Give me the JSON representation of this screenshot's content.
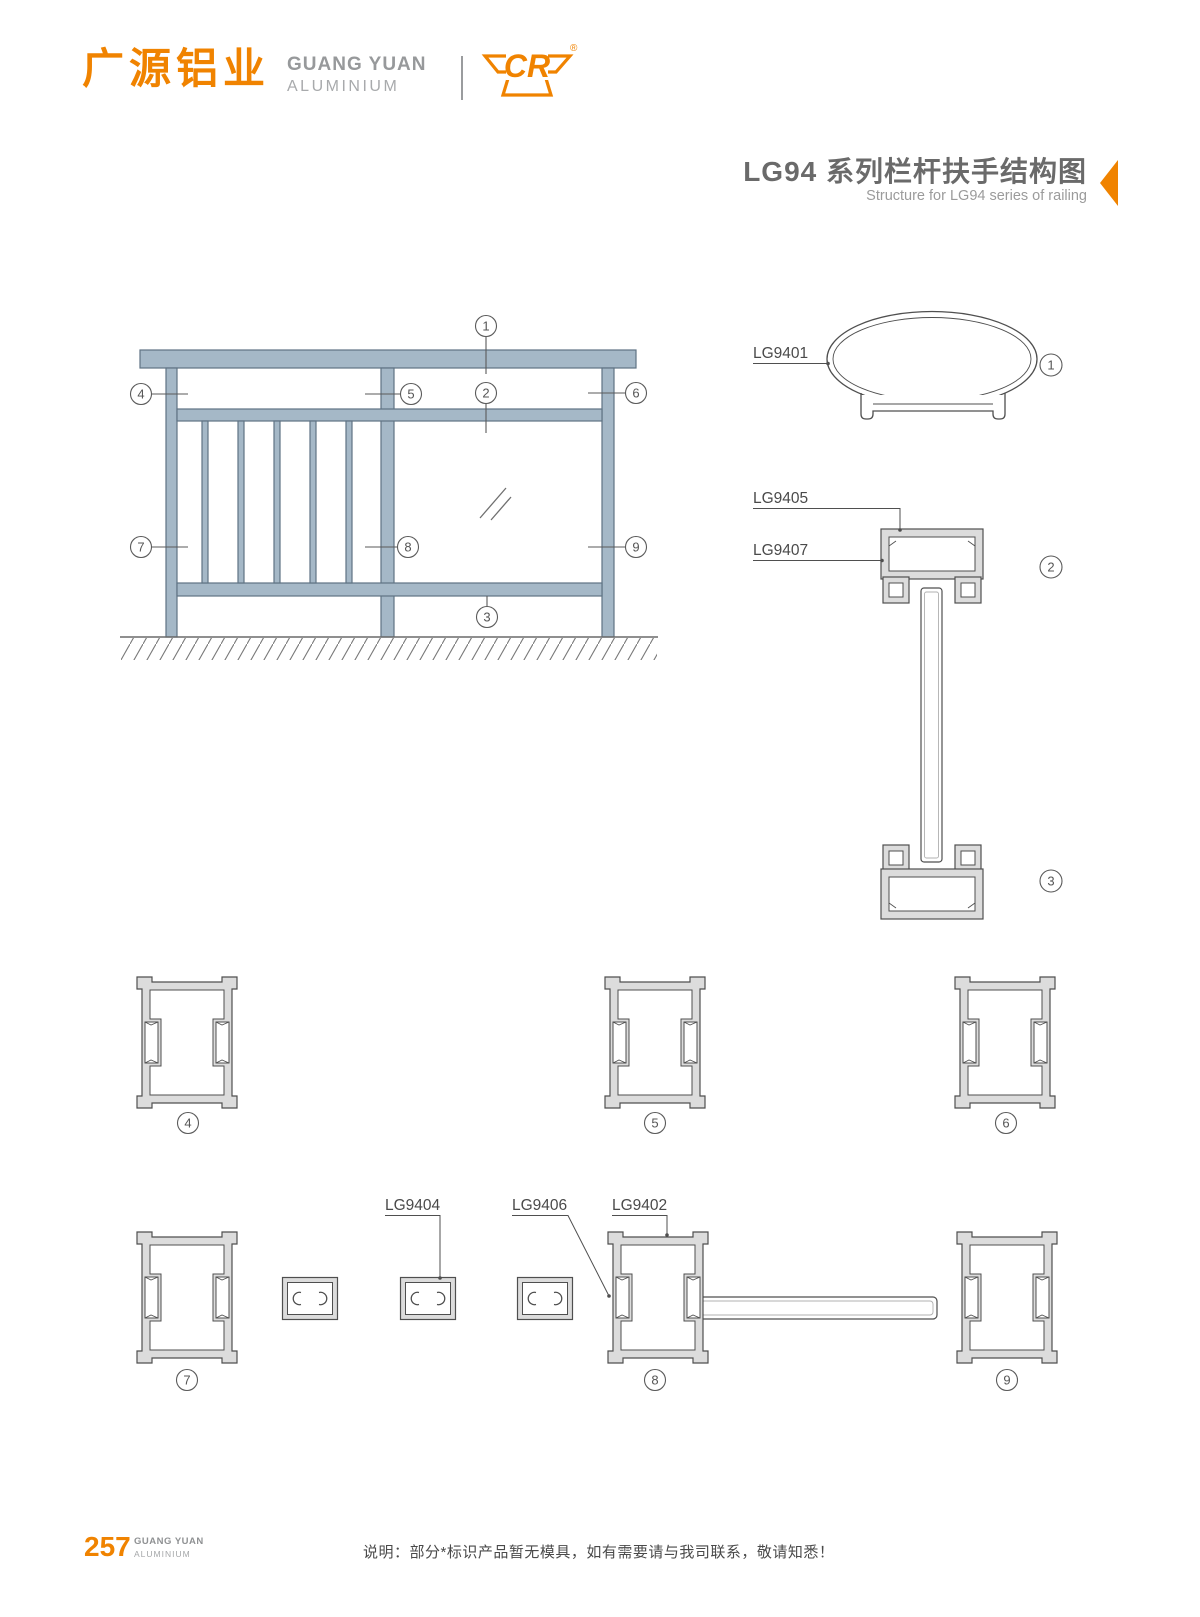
{
  "header": {
    "logo_cn": "广源铝业",
    "logo_en_1": "GUANG YUAN",
    "logo_en_2": "ALUMINIUM",
    "logo_mark": "CR",
    "logo_reg": "®",
    "title_cn": "LG94 系列栏杆扶手结构图",
    "title_en": "Structure for LG94 series of railing"
  },
  "diagram": {
    "callouts": {
      "c1": "1",
      "c2": "2",
      "c3": "3",
      "c4": "4",
      "c5": "5",
      "c6": "6",
      "c7": "7",
      "c8": "8",
      "c9": "9"
    },
    "profile_labels": {
      "handrail": "LG9401",
      "top_cap": "LG9405",
      "top_rail": "LG9407",
      "baluster_tube": "LG9404",
      "glass_clip": "LG9406",
      "post": "LG9402"
    }
  },
  "footer": {
    "page_number": "257",
    "brand_1": "GUANG YUAN",
    "brand_2": "ALUMINIUM",
    "note": "说明：部分*标识产品暂无模具，如有需要请与我司联系，敬请知悉！"
  },
  "colors": {
    "accent_orange": "#f08300",
    "railing_fill": "#a5b8c7",
    "railing_stroke": "#5f7384",
    "drawing_line": "#4f4f4f",
    "metal_fill": "#dcdcdc"
  }
}
